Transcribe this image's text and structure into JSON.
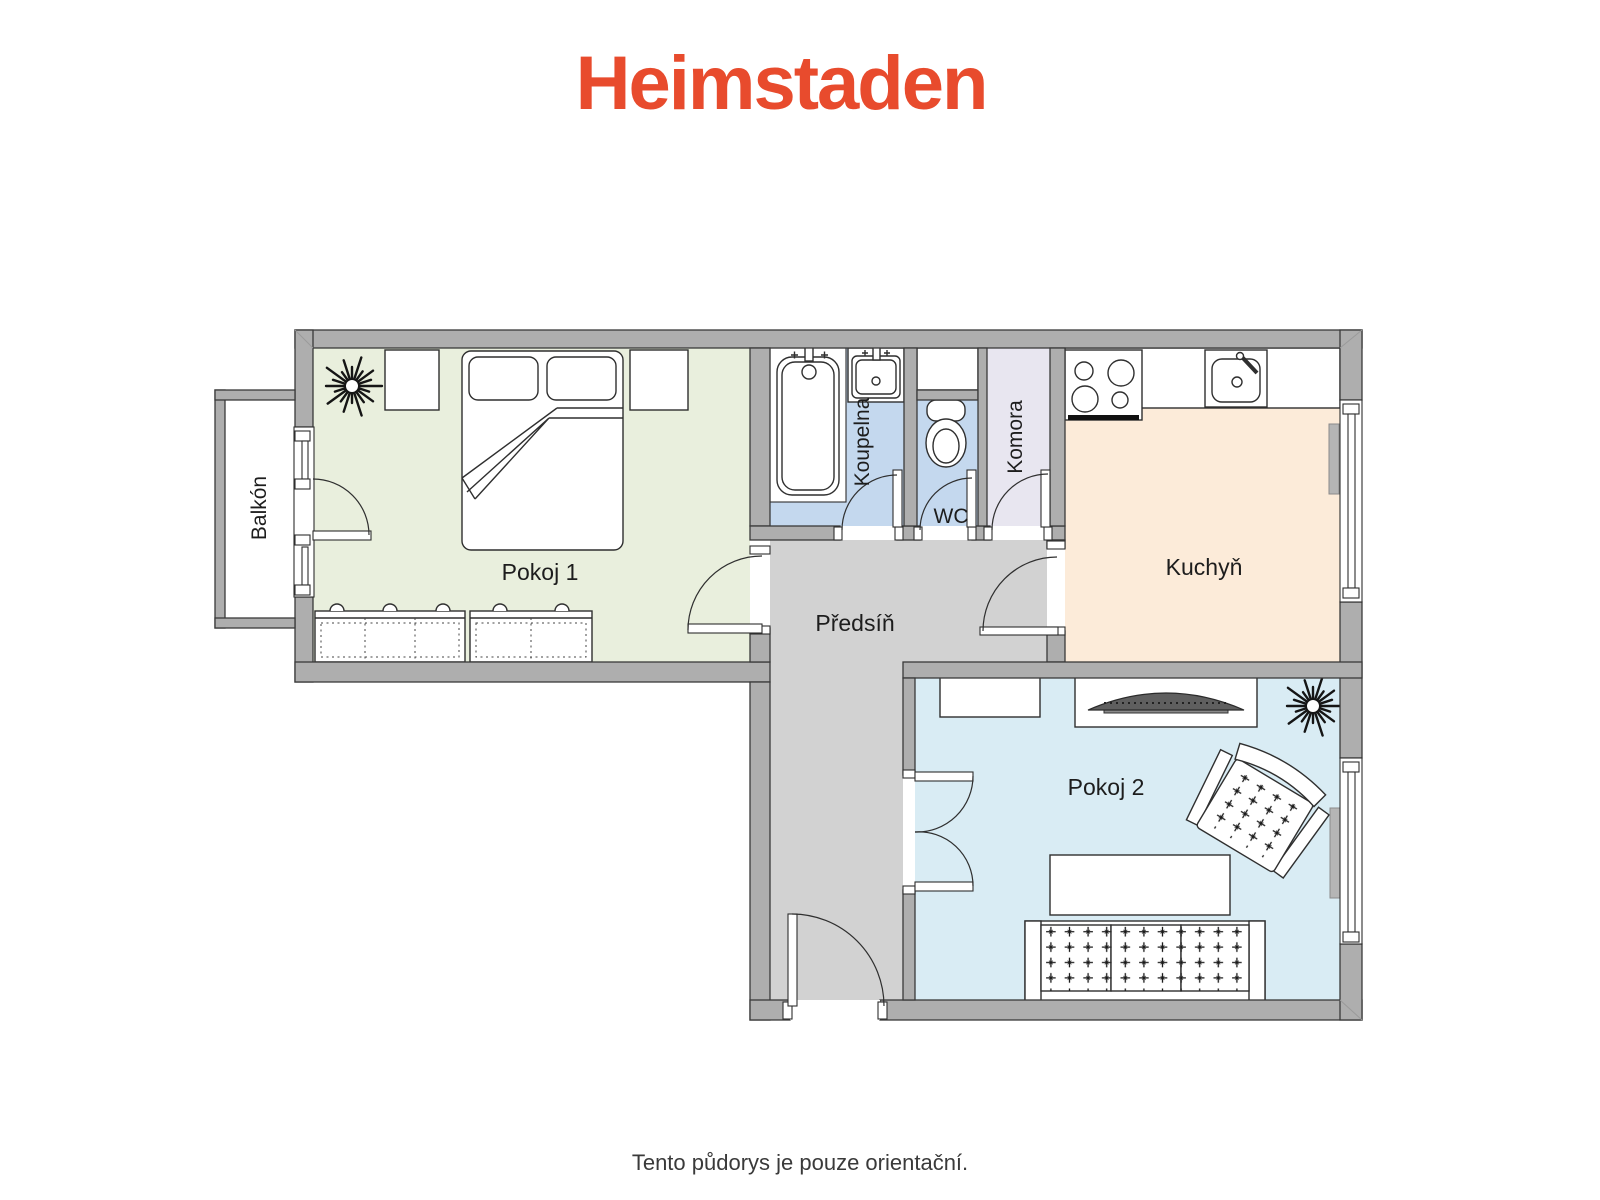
{
  "logo": {
    "text": "Heimstaden",
    "color": "#e84b2d"
  },
  "footer": {
    "text": "Tento půdorys je pouze orientační."
  },
  "rooms": {
    "balkon": {
      "label": "Balkón",
      "fill": "#ffffff"
    },
    "pokoj1": {
      "label": "Pokoj 1",
      "fill": "#e9efdd"
    },
    "koupelna": {
      "label": "Koupelna",
      "fill": "#c4d8ee"
    },
    "wc": {
      "label": "WC",
      "fill": "#c4d8ee"
    },
    "komora": {
      "label": "Komora",
      "fill": "#e8e6f0"
    },
    "kuchyn": {
      "label": "Kuchyň",
      "fill": "#fcebd9"
    },
    "predsin": {
      "label": "Předsíň",
      "fill": "#d2d2d2"
    },
    "pokoj2": {
      "label": "Pokoj 2",
      "fill": "#d9ecf4"
    }
  },
  "colors": {
    "accent": "#e84b2d",
    "wall": "#aeaeae",
    "wall_outline": "#3a3a3a",
    "label_text": "#1d1d1d"
  }
}
